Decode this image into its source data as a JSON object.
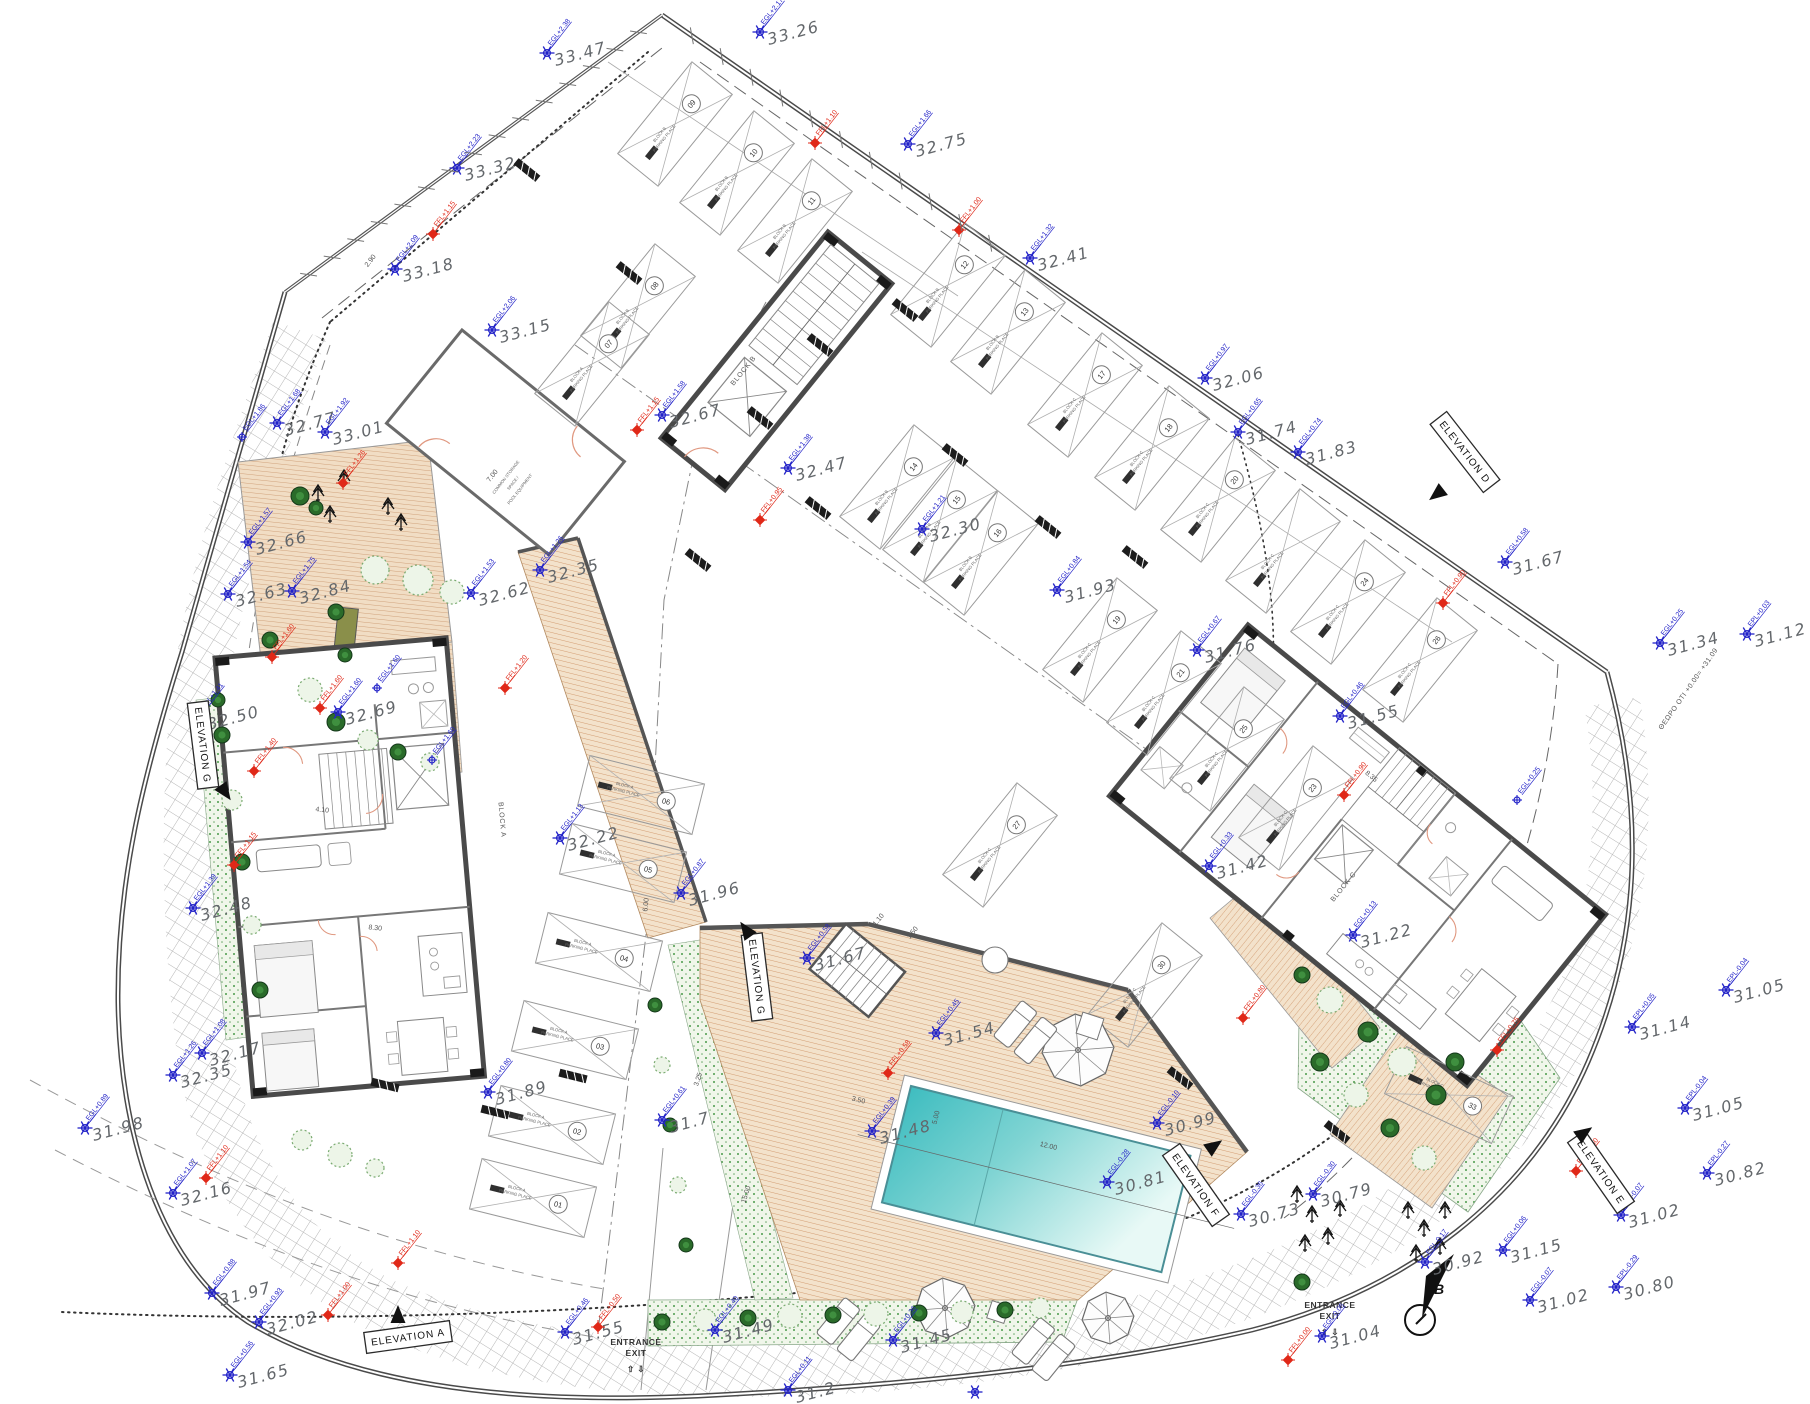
{
  "title": "site ground floor plan",
  "colors": {
    "survey_blue": "#2323c8",
    "ffl_red": "#e02818",
    "value_gray": "#63676b",
    "wall": "#4a4a4a",
    "thin": "#8a8a8a",
    "deck_base": "#f3e2cb",
    "deck_line": "#cf9468",
    "pool_dark": "#3fbdc0",
    "pool_light": "#e8f9f6",
    "garden_green": "#4a9a4a",
    "bush_dark": "#2a6b2a",
    "door_salmon": "#e09880"
  },
  "blocks": [
    {
      "label": "BLOCK A",
      "x": 500,
      "y": 820,
      "rot": 85
    },
    {
      "label": "BLOCK B",
      "x": 745,
      "y": 372,
      "rot": -51
    },
    {
      "label": "BLOCK C",
      "x": 1345,
      "y": 888,
      "rot": -51
    }
  ],
  "survey_points": [
    [
      "33.47",
      547,
      53,
      "EGL+2.38"
    ],
    [
      "33.26",
      760,
      32,
      "EGL+2.17"
    ],
    [
      "32.75",
      908,
      144,
      "EGL+1.66"
    ],
    [
      "32.41",
      1030,
      258,
      "EGL+1.32"
    ],
    [
      "33.32",
      457,
      168,
      "EGL+2.23"
    ],
    [
      "33.18",
      395,
      269,
      "EGL+2.09"
    ],
    [
      "33.15",
      492,
      330,
      "EGL+2.06"
    ],
    [
      "32.06",
      1205,
      378,
      "EGL+0.97"
    ],
    [
      "31.83",
      1298,
      452,
      "EGL+0.74"
    ],
    [
      "32.77",
      277,
      423,
      "EGL+1.68"
    ],
    [
      "33.01",
      325,
      432,
      "EGL+1.92"
    ],
    [
      "32.67",
      662,
      415,
      "EGL+1.58"
    ],
    [
      "32.47",
      788,
      468,
      "EGL+1.38"
    ],
    [
      "31.74",
      1238,
      432,
      "EGL+0.65"
    ],
    [
      "31.67",
      1505,
      562,
      "EGL+0.58"
    ],
    [
      "32.66",
      248,
      542,
      "EGL+1.57"
    ],
    [
      "32.84",
      292,
      591,
      "EGL+1.75"
    ],
    [
      "32.63",
      228,
      594,
      "EGL+1.54"
    ],
    [
      "32.62",
      471,
      593,
      "EGL+1.53"
    ],
    [
      "32.35",
      540,
      570,
      "EGL+1.26"
    ],
    [
      "32.30",
      922,
      529,
      "EGL+1.21"
    ],
    [
      "31.93",
      1057,
      590,
      "EGL+0.84"
    ],
    [
      "31.76",
      1197,
      650,
      "EGL+0.67"
    ],
    [
      "31.55",
      1340,
      716,
      "EGL+0.46"
    ],
    [
      "31.42",
      1209,
      866,
      "EGL+0.33"
    ],
    [
      "31.34",
      1660,
      643,
      "EGL+0.25"
    ],
    [
      "31.12",
      1747,
      634,
      "EPL+0.03"
    ],
    [
      "32.69",
      338,
      712,
      "EGL+1.60"
    ],
    [
      "32.48",
      193,
      908,
      "EGL+1.39"
    ],
    [
      "32.50",
      200,
      717,
      "EGL+1.41"
    ],
    [
      "32.22",
      560,
      838,
      "EGL+1.13"
    ],
    [
      "31.96",
      681,
      893,
      "EGL+0.87"
    ],
    [
      "31.67",
      807,
      958,
      "EGL+0.58"
    ],
    [
      "31.54",
      936,
      1033,
      "EGL+0.45"
    ],
    [
      "31.48",
      872,
      1131,
      "EGL+0.39"
    ],
    [
      "30.99",
      1157,
      1123,
      "EGL-0.10"
    ],
    [
      "30.81",
      1107,
      1182,
      "EGL-0.28"
    ],
    [
      "30.73",
      1241,
      1214,
      "EGL-0.36"
    ],
    [
      "30.79",
      1313,
      1194,
      "EGL-0.30"
    ],
    [
      "31.22",
      1353,
      935,
      "EGL+0.13"
    ],
    [
      "31.14",
      1632,
      1027,
      "EPL+0.05"
    ],
    [
      "31.05",
      1726,
      990,
      "EPL-0.04"
    ],
    [
      "31.05",
      1685,
      1108,
      "EPL-0.04"
    ],
    [
      "30.82",
      1707,
      1173,
      "EPL-0.27"
    ],
    [
      "31.02",
      1621,
      1215,
      "EPL-0.07"
    ],
    [
      "31.02",
      1530,
      1300,
      "EGL-0.07"
    ],
    [
      "30.80",
      1616,
      1287,
      "EPL-0.29"
    ],
    [
      "30.92",
      1425,
      1262,
      "EGL-0.17"
    ],
    [
      "31.04",
      1322,
      1336,
      "EGL-0.05"
    ],
    [
      "31.15",
      1503,
      1250,
      "EGL+0.06"
    ],
    [
      "32.17",
      202,
      1053,
      "EGL+1.08"
    ],
    [
      "32.35",
      173,
      1075,
      "EGL+1.26"
    ],
    [
      "31.98",
      85,
      1128,
      "EGL+0.89"
    ],
    [
      "32.16",
      173,
      1193,
      "EGL+1.07"
    ],
    [
      "31.97",
      212,
      1293,
      "EGL+0.88"
    ],
    [
      "32.02",
      259,
      1322,
      "EGL+0.93"
    ],
    [
      "31.65",
      230,
      1375,
      "EGL+0.56"
    ],
    [
      "31.89",
      488,
      1092,
      "EGL+0.80"
    ],
    [
      "31.7",
      662,
      1120,
      "EGL+0.61"
    ],
    [
      "31.55",
      565,
      1332,
      "EGL+0.46"
    ],
    [
      "31.49",
      715,
      1330,
      "EGL+0.40"
    ],
    [
      "31.45",
      893,
      1340,
      "EGL+0.36"
    ],
    [
      "31.2",
      788,
      1390,
      "EGL+0.11"
    ],
    [
      "",
      975,
      1392,
      ""
    ]
  ],
  "ffl_points": [
    [
      815,
      143,
      "FFL+1.10"
    ],
    [
      959,
      230,
      "FFL+1.00"
    ],
    [
      433,
      234,
      "FFL+1.15"
    ],
    [
      637,
      430,
      "FFL+1.15"
    ],
    [
      760,
      520,
      "FFL+0.95"
    ],
    [
      1443,
      603,
      "FFL+0.90"
    ],
    [
      343,
      483,
      "FFL+1.26"
    ],
    [
      272,
      657,
      "FFL+1.60"
    ],
    [
      320,
      708,
      "FFL+1.60"
    ],
    [
      254,
      771,
      "FFL+1.40"
    ],
    [
      234,
      865,
      "FFL+1.15"
    ],
    [
      206,
      1178,
      "FFL+1.10"
    ],
    [
      328,
      1315,
      "FFL+1.00"
    ],
    [
      398,
      1263,
      "FFL+1.10"
    ],
    [
      598,
      1327,
      "FFL+0.50"
    ],
    [
      1288,
      1360,
      "FFL+0.00"
    ],
    [
      1243,
      1018,
      "FFL+0.80"
    ],
    [
      888,
      1073,
      "FFL+0.58"
    ],
    [
      1497,
      1050,
      "FFL+0.75"
    ],
    [
      1576,
      1171,
      "FFL+0.60"
    ],
    [
      505,
      688,
      "FFL+1.20"
    ],
    [
      1344,
      795,
      "FFL+0.90"
    ]
  ],
  "egl_only": [
    [
      377,
      688,
      "EGL+1.60"
    ],
    [
      242,
      437,
      "EGL+1.86"
    ],
    [
      432,
      760,
      "EGL+1.60"
    ],
    [
      1517,
      800,
      "EGL+0.25"
    ]
  ],
  "elevation_markers": [
    {
      "label": "ELEVATION A",
      "x": 408,
      "y": 1337,
      "rot": -8,
      "ax": 398,
      "ay": 1315,
      "adir": 0
    },
    {
      "label": "ELEVATION D",
      "x": 1465,
      "y": 452,
      "rot": 52,
      "ax": 1437,
      "ay": 494,
      "adir": 232
    },
    {
      "label": "ELEVATION E",
      "x": 1601,
      "y": 1172,
      "rot": 55,
      "ax": 1584,
      "ay": 1133,
      "adir": 55
    },
    {
      "label": "ELEVATION F",
      "x": 1196,
      "y": 1185,
      "rot": 55,
      "ax": 1214,
      "ay": 1146,
      "adir": 55
    },
    {
      "label": "ELEVATION G",
      "x": 203,
      "y": 745,
      "rot": 83,
      "ax": 225,
      "ay": 792,
      "adir": 145
    },
    {
      "label": "ELEVATION G",
      "x": 757,
      "y": 977,
      "rot": 83,
      "ax": 746,
      "ay": 930,
      "adir": -35
    }
  ],
  "entrances": [
    {
      "line1": "ENTRANCE",
      "line2": "EXIT",
      "arrows": "⇧ ⇩",
      "x": 636,
      "y": 1345
    },
    {
      "line1": "ENTRANCE",
      "line2": "EXIT",
      "arrows": "⇧ ⇩",
      "x": 1330,
      "y": 1308
    }
  ],
  "storage_room": {
    "lines": [
      "COMMON STORAGE",
      "SPACE /",
      "POOL EQUIPMENT"
    ],
    "x": 507,
    "y": 478,
    "rot": -52
  },
  "datum_note": {
    "text": "ΘΕΩΡΟ ΟΤΙ +0.00= +31.09",
    "x": 1690,
    "y": 690,
    "rot": -55
  },
  "section_marker": {
    "label": "B",
    "x": 1420,
    "y": 1320
  },
  "parking": {
    "place_text": "PARKING PLACE",
    "block_prefix": "BLOCK",
    "stalls": [
      [
        "09",
        675,
        124,
        -51,
        "B"
      ],
      [
        "10",
        737,
        173,
        -51,
        "B"
      ],
      [
        "11",
        795,
        221,
        -51,
        "B"
      ],
      [
        "12",
        948,
        285,
        -51,
        "B"
      ],
      [
        "13",
        1008,
        332,
        -51,
        "B"
      ],
      [
        "08",
        638,
        306,
        -51,
        "B"
      ],
      [
        "07",
        592,
        364,
        -51,
        "A"
      ],
      [
        "17",
        1085,
        395,
        -51,
        "C"
      ],
      [
        "18",
        1152,
        448,
        -51,
        "C"
      ],
      [
        "20",
        1218,
        500,
        -51,
        "C"
      ],
      [
        "",
        1283,
        551,
        -51,
        "C"
      ],
      [
        "24",
        1348,
        602,
        -51,
        "C"
      ],
      [
        "26",
        1420,
        660,
        -51,
        "C"
      ],
      [
        "14",
        897,
        487,
        -51,
        "B"
      ],
      [
        "15",
        940,
        520,
        -51,
        "B"
      ],
      [
        "16",
        981,
        553,
        -51,
        "B"
      ],
      [
        "19",
        1100,
        640,
        -51,
        "C"
      ],
      [
        "21",
        1164,
        693,
        -51,
        "C"
      ],
      [
        "25",
        1227,
        749,
        -51,
        "C"
      ],
      [
        "23",
        1296,
        808,
        -51,
        "C"
      ],
      [
        "01",
        533,
        1198,
        14,
        "A"
      ],
      [
        "02",
        552,
        1125,
        14,
        "A"
      ],
      [
        "03",
        575,
        1040,
        14,
        "A"
      ],
      [
        "04",
        599,
        952,
        14,
        "A"
      ],
      [
        "05",
        623,
        863,
        14,
        "A"
      ],
      [
        "06",
        641,
        795,
        14,
        "A"
      ],
      [
        "27",
        1000,
        845,
        -51,
        "C"
      ],
      [
        "30",
        1145,
        985,
        -51,
        "C"
      ],
      [
        "33",
        1449,
        1095,
        25,
        "C"
      ]
    ]
  },
  "wheel_stops": [
    [
      527,
      170,
      39
    ],
    [
      629,
      273,
      39
    ],
    [
      905,
      310,
      39
    ],
    [
      820,
      345,
      39
    ],
    [
      955,
      455,
      39
    ],
    [
      1048,
      527,
      39
    ],
    [
      1135,
      557,
      39
    ],
    [
      818,
      508,
      39
    ],
    [
      760,
      418,
      39
    ],
    [
      573,
      1076,
      14
    ],
    [
      495,
      1112,
      14
    ],
    [
      385,
      1085,
      14
    ],
    [
      1180,
      1078,
      39
    ],
    [
      1337,
      1132,
      39
    ],
    [
      698,
      560,
      39
    ]
  ],
  "dims": [
    [
      "12.00",
      1048,
      1148,
      14
    ],
    [
      "5.00",
      938,
      1118,
      -76
    ],
    [
      "15.00",
      748,
      1195,
      -72
    ],
    [
      "7.00",
      494,
      477,
      -52
    ],
    [
      "2.90",
      372,
      262,
      -52
    ],
    [
      "2.50",
      1210,
      1198,
      14
    ],
    [
      "3.50",
      858,
      1102,
      14
    ],
    [
      "8.30",
      375,
      930,
      6
    ],
    [
      "4.10",
      322,
      812,
      6
    ],
    [
      "8.35",
      1370,
      778,
      39
    ],
    [
      "6.00",
      648,
      905,
      -84
    ],
    [
      "1.10",
      880,
      921,
      -51
    ],
    [
      "1.50",
      914,
      934,
      -51
    ],
    [
      "3.25",
      700,
      1080,
      -72
    ]
  ],
  "pool": {
    "x": 911,
    "y": 1086,
    "rot": 14,
    "length": 288,
    "width": 120
  },
  "trees": {
    "conifers": [
      [
        318,
        495
      ],
      [
        330,
        516
      ],
      [
        344,
        480
      ],
      [
        388,
        508
      ],
      [
        401,
        524
      ],
      [
        1297,
        1196
      ],
      [
        1312,
        1216
      ],
      [
        1328,
        1238
      ],
      [
        1305,
        1245
      ],
      [
        1340,
        1210
      ],
      [
        1408,
        1212
      ],
      [
        1424,
        1230
      ],
      [
        1440,
        1248
      ],
      [
        1416,
        1255
      ],
      [
        1445,
        1212
      ]
    ],
    "bushes": [
      [
        300,
        496,
        9,
        "d"
      ],
      [
        316,
        508,
        7,
        "d"
      ],
      [
        336,
        612,
        8,
        "d"
      ],
      [
        270,
        640,
        8,
        "d"
      ],
      [
        345,
        655,
        7,
        "d"
      ],
      [
        375,
        570,
        14,
        "c"
      ],
      [
        418,
        580,
        15,
        "c"
      ],
      [
        452,
        592,
        12,
        "c"
      ],
      [
        310,
        690,
        12,
        "c"
      ],
      [
        336,
        722,
        9,
        "d"
      ],
      [
        368,
        740,
        10,
        "c"
      ],
      [
        398,
        752,
        8,
        "d"
      ],
      [
        430,
        762,
        9,
        "c"
      ],
      [
        218,
        700,
        7,
        "d"
      ],
      [
        222,
        735,
        8,
        "d"
      ],
      [
        232,
        800,
        10,
        "c"
      ],
      [
        242,
        862,
        8,
        "d"
      ],
      [
        252,
        925,
        9,
        "c"
      ],
      [
        260,
        990,
        8,
        "d"
      ],
      [
        302,
        1140,
        10,
        "c"
      ],
      [
        340,
        1155,
        12,
        "c"
      ],
      [
        375,
        1168,
        9,
        "c"
      ],
      [
        662,
        1322,
        8,
        "d"
      ],
      [
        705,
        1320,
        11,
        "c"
      ],
      [
        748,
        1318,
        8,
        "d"
      ],
      [
        790,
        1316,
        12,
        "c"
      ],
      [
        833,
        1315,
        8,
        "d"
      ],
      [
        876,
        1314,
        12,
        "c"
      ],
      [
        919,
        1313,
        8,
        "d"
      ],
      [
        962,
        1312,
        11,
        "c"
      ],
      [
        1005,
        1310,
        8,
        "d"
      ],
      [
        1040,
        1308,
        10,
        "c"
      ],
      [
        655,
        1005,
        7,
        "d"
      ],
      [
        662,
        1065,
        8,
        "c"
      ],
      [
        670,
        1125,
        7,
        "d"
      ],
      [
        678,
        1185,
        8,
        "c"
      ],
      [
        686,
        1245,
        7,
        "d"
      ],
      [
        1330,
        1000,
        13,
        "c"
      ],
      [
        1368,
        1032,
        10,
        "d"
      ],
      [
        1402,
        1062,
        14,
        "c"
      ],
      [
        1436,
        1095,
        10,
        "d"
      ],
      [
        1320,
        1062,
        9,
        "d"
      ],
      [
        1356,
        1095,
        12,
        "c"
      ],
      [
        1390,
        1128,
        9,
        "d"
      ],
      [
        1424,
        1158,
        12,
        "c"
      ],
      [
        1302,
        975,
        8,
        "d"
      ],
      [
        1455,
        1062,
        9,
        "d"
      ],
      [
        1302,
        1282,
        8,
        "d"
      ]
    ]
  },
  "furniture": {
    "umbrellas": [
      [
        1078,
        1050,
        36
      ],
      [
        945,
        1308,
        30
      ],
      [
        1108,
        1318,
        26
      ]
    ],
    "lounger_pairs": [
      [
        1022,
        1000,
        39
      ],
      [
        845,
        1297,
        39
      ],
      [
        1040,
        1317,
        39
      ]
    ],
    "tables": [
      [
        1090,
        1026,
        11
      ],
      [
        998,
        1312,
        9
      ]
    ],
    "round_tables": [
      [
        995,
        960,
        13
      ]
    ]
  }
}
